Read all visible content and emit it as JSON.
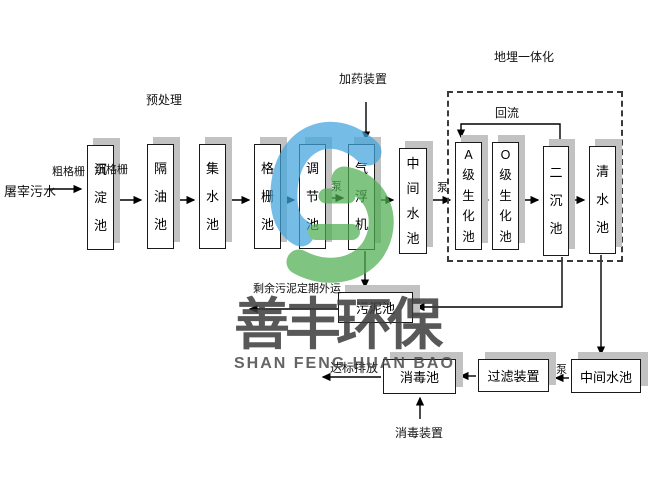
{
  "diagram_title": "屠宰污水处理工艺流程",
  "annotations": {
    "source": "屠宰污水",
    "coarse_screen": "粗格栅",
    "fine_screen": "细格栅",
    "pretreatment": "预处理",
    "dosing_device": "加药装置",
    "buried_integration": "地埋一体化",
    "reflux": "回流",
    "pump": "泵",
    "sludge_out": "剩余污泥定期外运",
    "discharge": "达标排放",
    "disinfection_device": "消毒装置"
  },
  "tanks": [
    {
      "label": "沉淀池"
    },
    {
      "label": "隔油池"
    },
    {
      "label": "集水池"
    },
    {
      "label": "格栅池"
    },
    {
      "label": "调节池"
    },
    {
      "label": "气浮机"
    },
    {
      "label": "中间水池"
    },
    {
      "label": "A级生化池"
    },
    {
      "label": "O级生化池"
    },
    {
      "label": "二沉池"
    },
    {
      "label": "清水池"
    }
  ],
  "bottom_boxes": [
    {
      "label": "污泥池"
    },
    {
      "label": "消毒池"
    },
    {
      "label": "过滤装置"
    },
    {
      "label": "中间水池"
    }
  ],
  "watermark": {
    "brand_cn": "善丰环保",
    "brand_en": "SHAN FENG HUAN BAO",
    "logo_blue": "#41a5dd",
    "logo_green": "#4fae51",
    "text_gray": "#3c3c3c"
  },
  "style": {
    "box_border": "#1a1a1a",
    "box_shadow": "#c2c2c2",
    "line_color": "#000000",
    "background": "#ffffff"
  }
}
